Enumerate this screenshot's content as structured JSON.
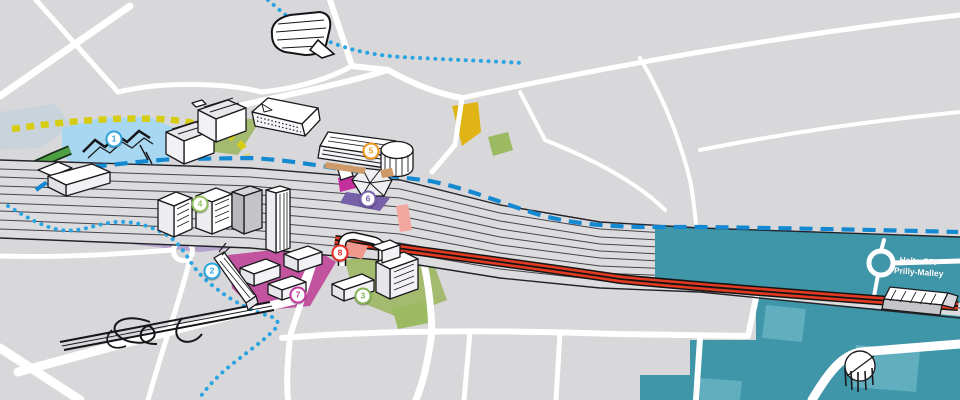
{
  "map": {
    "description": "Illustrated isometric urban development map of the Prilly-Malley railway area",
    "station_label": {
      "line1": "Halte CFF",
      "line2": "Prilly-Malley"
    },
    "markers": [
      {
        "number": "1",
        "color": "#33A3DC",
        "x": 114,
        "y": 139
      },
      {
        "number": "2",
        "color": "#29A8E0",
        "x": 212,
        "y": 271
      },
      {
        "number": "3",
        "color": "#85B254",
        "x": 363,
        "y": 296
      },
      {
        "number": "4",
        "color": "#8FBF5E",
        "x": 200,
        "y": 204
      },
      {
        "number": "5",
        "color": "#F0981E",
        "x": 371,
        "y": 151
      },
      {
        "number": "6",
        "color": "#7660A8",
        "x": 368,
        "y": 199
      },
      {
        "number": "7",
        "color": "#C53AA0",
        "x": 298,
        "y": 295
      },
      {
        "number": "8",
        "color": "#E73029",
        "x": 340,
        "y": 253
      }
    ],
    "routes": [
      {
        "id": "route-blue-dashed",
        "color": "#1489D2",
        "style": "dashed"
      },
      {
        "id": "route-blue-dotted",
        "color": "#2BA5E2",
        "style": "dotted"
      },
      {
        "id": "route-yellow-dashed",
        "color": "#D6CD12",
        "style": "dashed"
      },
      {
        "id": "tram-line-red",
        "color": "#E23A22",
        "style": "double-solid"
      }
    ],
    "palette": {
      "land_gray": "#D8D8DA",
      "rail_corridor_gray": "#DCDCDE",
      "road_white": "#FFFFFF",
      "district_teal": "#3F96A8",
      "district_teal_light": "#60AEBE",
      "water_blue": "#A8D8F1",
      "zone_purple": "#B4A2CC",
      "zone_magenta": "#C1539F",
      "zone_olive_green": "#A3BA6F",
      "zone_yellow": "#DFB414",
      "zone_salmon": "#DC7262",
      "ramp_green": "#4E9F42"
    }
  }
}
